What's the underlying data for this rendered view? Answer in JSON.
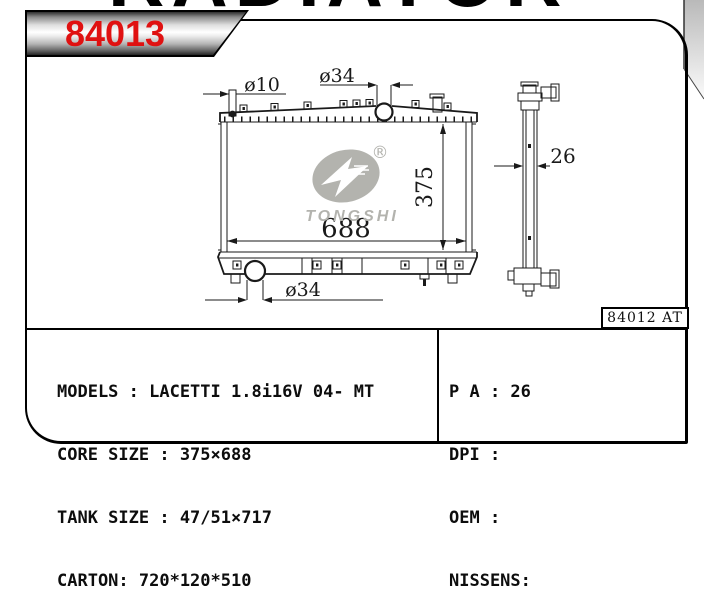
{
  "page": {
    "top_title": "RADIATOR",
    "corner_letter": "D",
    "accent_red": "#e01111",
    "line_color": "#1a1a1a",
    "logo_gray": "#b3b3ae"
  },
  "banner": {
    "part_number": "84013"
  },
  "drawing": {
    "dimensions": {
      "top_left_pipe_diameter": "ø10",
      "top_center_pipe_diameter": "ø34",
      "core_height": "375",
      "core_width": "688",
      "bottom_pipe_diameter": "ø34",
      "thickness": "26"
    },
    "logo": {
      "brand": "TONGSHI",
      "registered": "®"
    },
    "reference_box": "84012 AT"
  },
  "specs": {
    "left": [
      "MODELS : LACETTI 1.8i16V 04- MT",
      "CORE SIZE : 375×688",
      "TANK SIZE : 47/51×717",
      "CARTON: 720*120*510"
    ],
    "right": [
      "P A : 26",
      "DPI :",
      "OEM :",
      "NISSENS:"
    ]
  }
}
